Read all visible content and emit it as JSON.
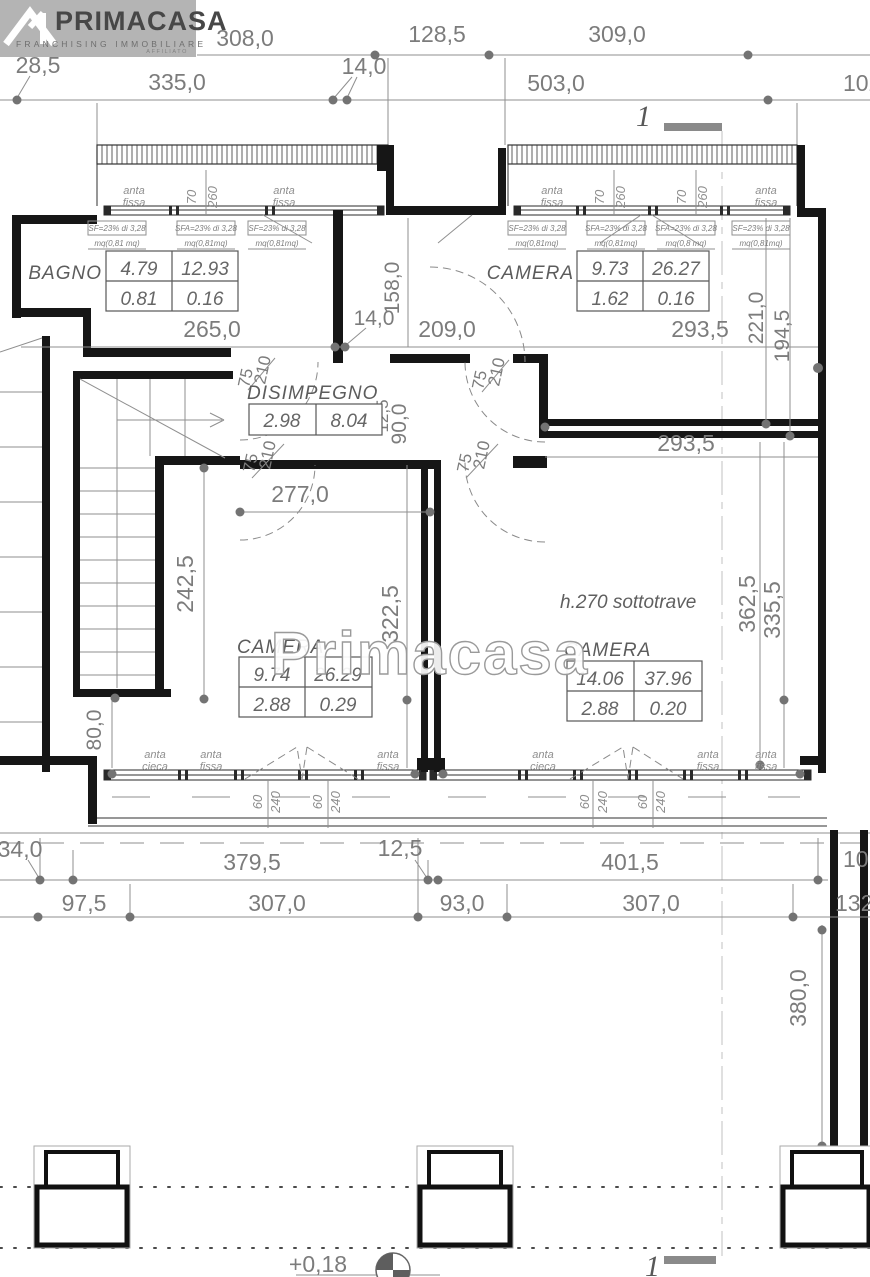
{
  "logo": {
    "brand": "PRIMACASA",
    "tagline": "FRANCHISING IMMOBILIARE",
    "badge": "AFFILIATO"
  },
  "markers": {
    "section_top": "1",
    "section_bottom": "1",
    "level": "+0,18"
  },
  "watermark": "Primacasa",
  "notes": {
    "beam": "h.270 sottotrave"
  },
  "top_dims": {
    "a": "308,0",
    "b": "128,5",
    "c": "309,0",
    "d": "28,5",
    "e": "335,0",
    "f": "14,0",
    "g": "503,0",
    "h": "102"
  },
  "plan_dims": {
    "w265": "265,0",
    "w14": "14,0",
    "h158": "158,0",
    "w209": "209,0",
    "w293a": "293,5",
    "h221": "221,0",
    "h194": "194,5",
    "w293b": "293,5",
    "w277": "277,0",
    "h242": "242,5",
    "h90": "90,0",
    "t12": "12,5",
    "h322": "322,5",
    "h362": "362,5",
    "h335": "335,5",
    "h80": "80,0"
  },
  "bottom_dims": {
    "a": "34,0",
    "b": "379,5",
    "c": "12,5",
    "d": "401,5",
    "e": "10",
    "f": "97,5",
    "g": "307,0",
    "h": "93,0",
    "i": "307,0",
    "j": "132,",
    "k": "380,0"
  },
  "door": {
    "w": "75",
    "h": "210"
  },
  "window": {
    "w70": "70",
    "h260": "260",
    "w60": "60",
    "h240": "240",
    "anta": "anta",
    "fissa": "fissa",
    "cieca": "cieca"
  },
  "sf": {
    "sf1": "SF=23% di 3,28",
    "sfa1": "SFA=23% di 3,28",
    "m81a": "mq(0,81 mq)",
    "m81b": "mq(0,81mq)",
    "m80": "mq(0,8 mq)"
  },
  "rooms": {
    "bagno": {
      "name": "BAGNO",
      "r1": [
        "4.79",
        "12.93"
      ],
      "r2": [
        "0.81",
        "0.16"
      ]
    },
    "camera_ne": {
      "name": "CAMERA",
      "r1": [
        "9.73",
        "26.27"
      ],
      "r2": [
        "1.62",
        "0.16"
      ]
    },
    "disimpegno": {
      "name": "DISIMPEGNO",
      "r1": [
        "2.98",
        "8.04"
      ]
    },
    "camera_sw": {
      "name": "CAMERA",
      "r1": [
        "9.74",
        "26.29"
      ],
      "r2": [
        "2.88",
        "0.29"
      ]
    },
    "camera_se": {
      "name": "CAMERA",
      "r1": [
        "14.06",
        "37.96"
      ],
      "r2": [
        "2.88",
        "0.20"
      ]
    }
  }
}
